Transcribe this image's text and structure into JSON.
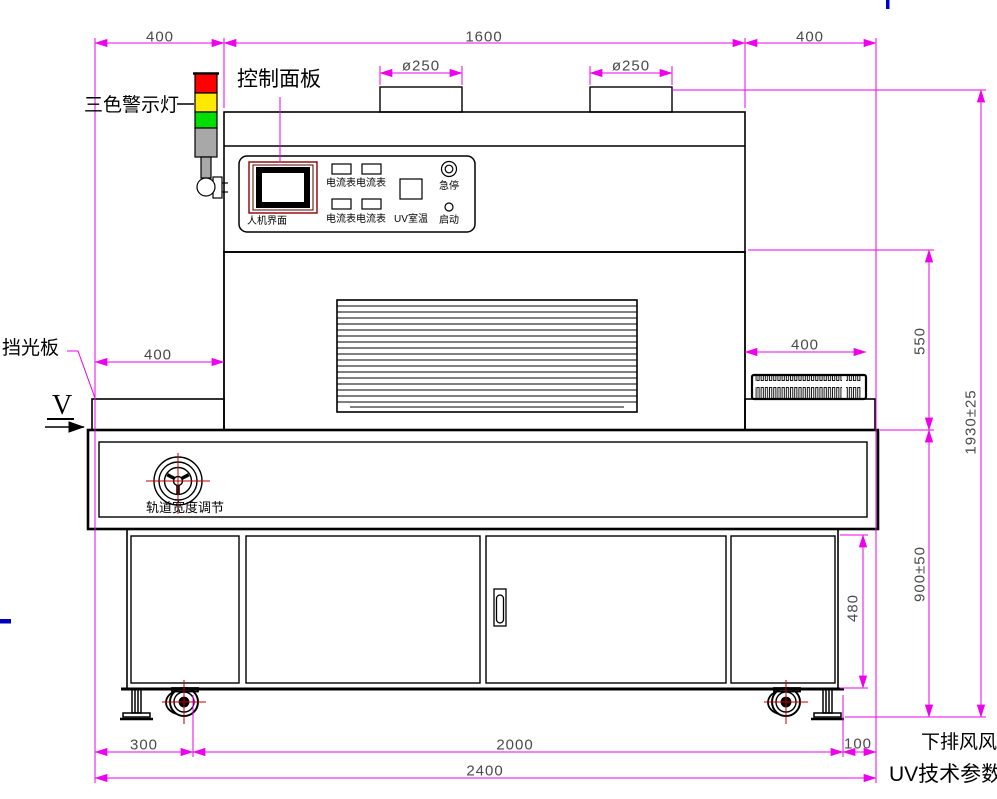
{
  "colors": {
    "dimension_line": "#ee00ee",
    "drawing_line": "#000000",
    "dimension_text": "#4a4a4a",
    "label_text": "#000000",
    "warning_red": "#ff0000",
    "warning_yellow": "#ffe800",
    "warning_green": "#00dd00",
    "warning_gray": "#a8a8a8",
    "crosshair_red": "#bb0000",
    "hmi_frame_red": "#8b0000",
    "artifact_blue": "#0000cc"
  },
  "annotations": {
    "warning_light": "三色警示灯",
    "control_panel": "控制面板",
    "light_shield": "挡光板",
    "view_marker": "V",
    "track_width_adjust": "轨道宽度调节",
    "bottom_exhaust": "下排风风",
    "uv_tech_params": "UV技术参数"
  },
  "panel": {
    "hmi": "人机界面",
    "ammeters": [
      "电流表",
      "电流表",
      "电流表",
      "电流表"
    ],
    "uv_temp": "UV室温",
    "estop": "急停",
    "start": "启动"
  },
  "dimensions": {
    "top_left": "400",
    "top_center": "1600",
    "top_right": "400",
    "duct_left": "ø250",
    "duct_right": "ø250",
    "shelf_left": "400",
    "shelf_right": "400",
    "chamber_height": "550",
    "total_height": "1930±25",
    "base_height": "900±50",
    "cabinet_height": "480",
    "bottom_left": "300",
    "bottom_center": "2000",
    "bottom_right": "100",
    "bottom_total": "2400"
  }
}
